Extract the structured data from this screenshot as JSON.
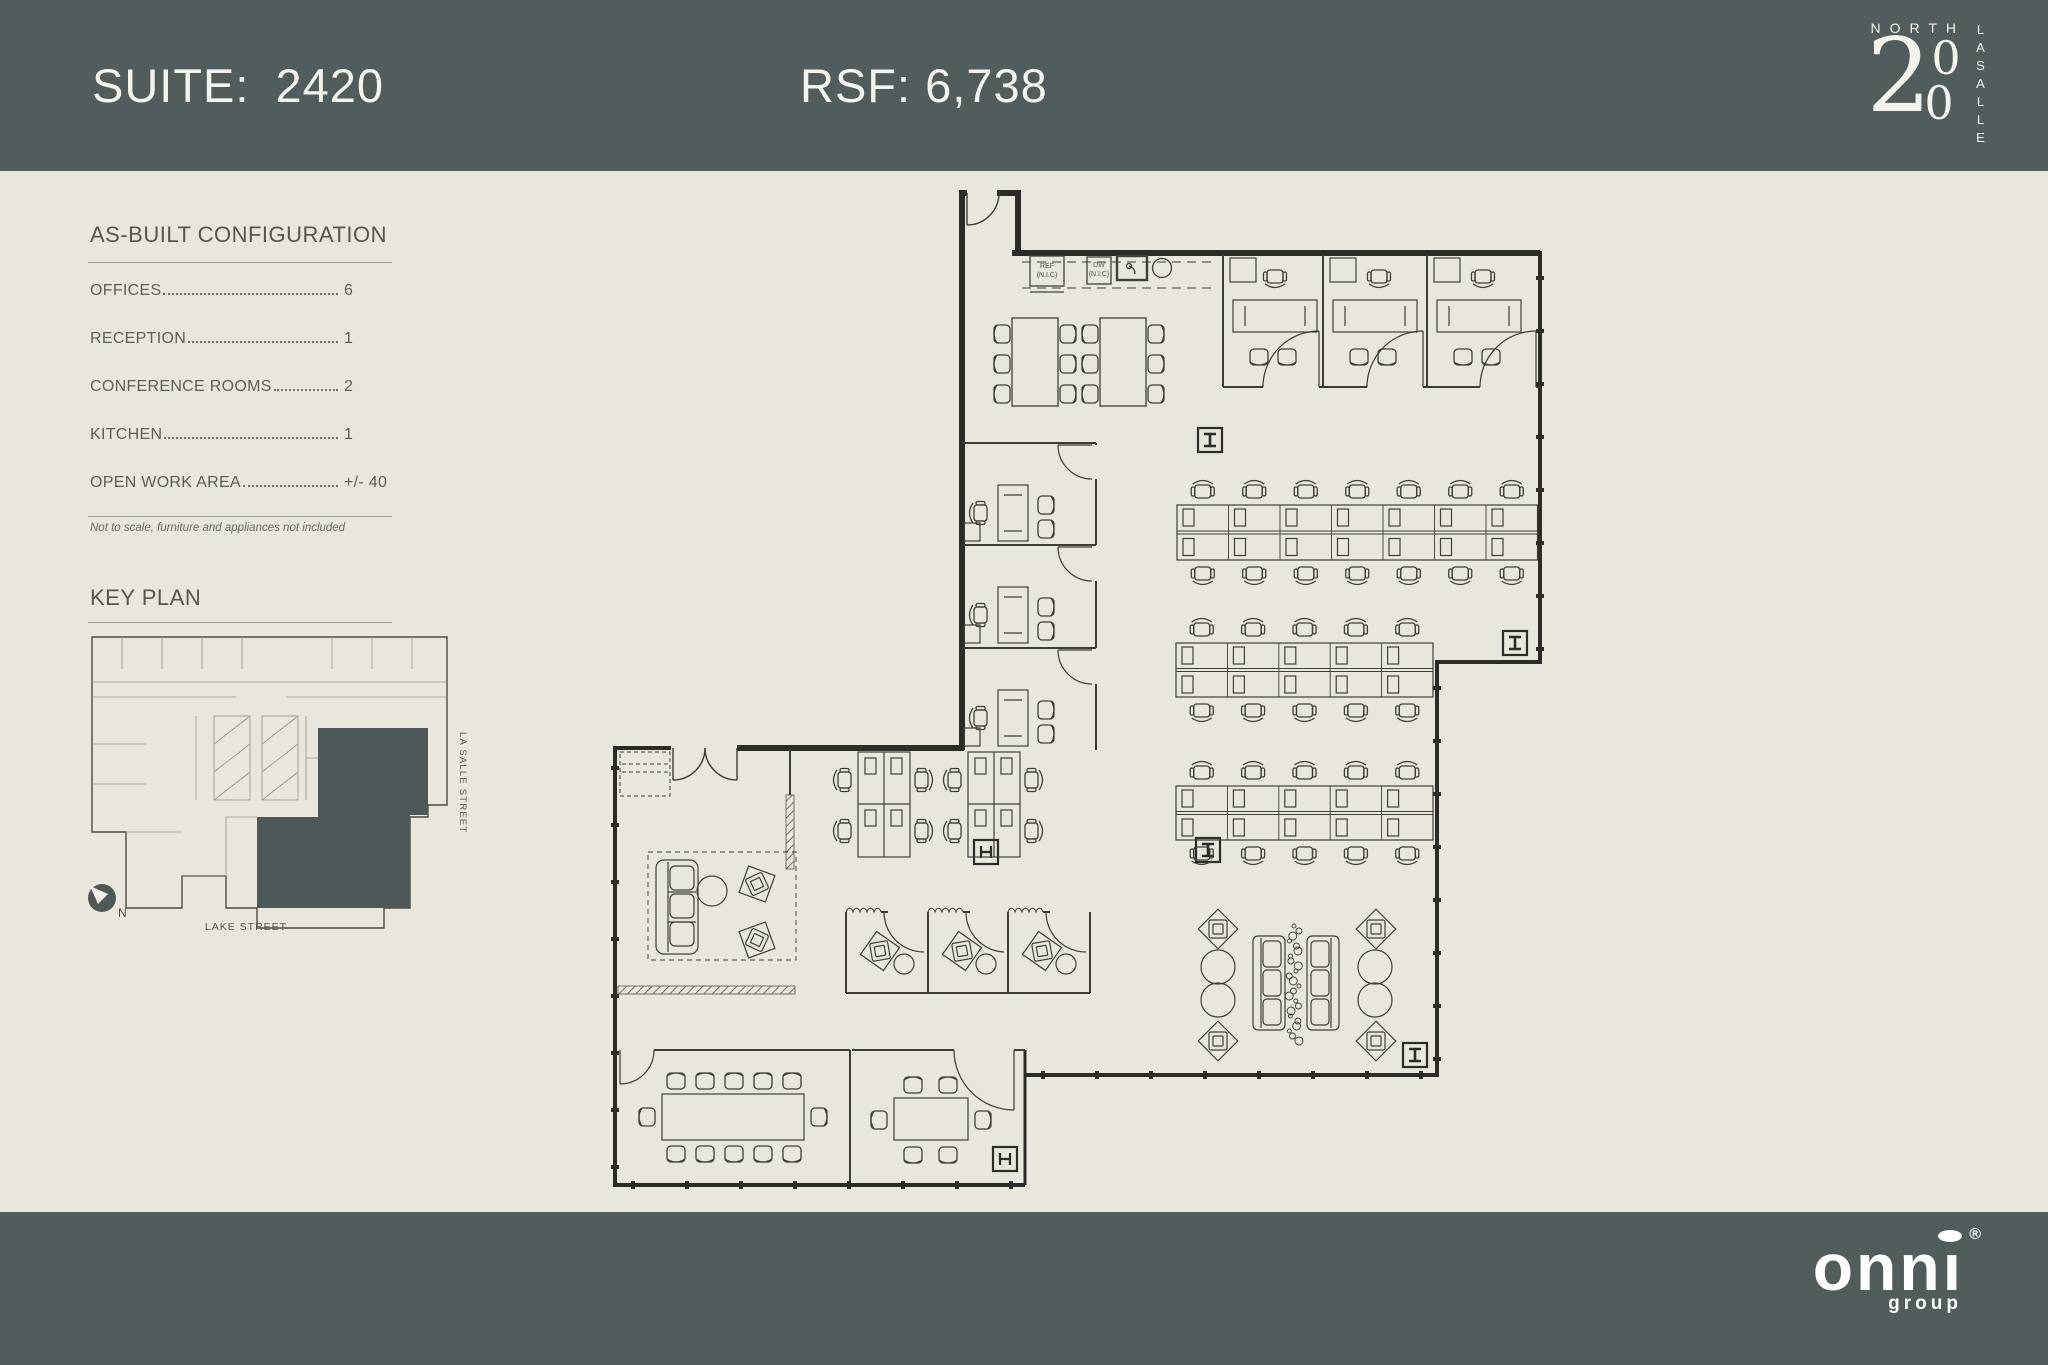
{
  "header": {
    "suite_label": "SUITE:",
    "suite_number": "2420",
    "rsf": "RSF: 6,738",
    "logo": {
      "north": "NORTH",
      "big_two": "2",
      "zero_top": "0",
      "zero_bottom": "0",
      "lasalle": "LASALLE"
    }
  },
  "sidebar": {
    "config_title": "AS-BUILT CONFIGURATION",
    "items": [
      {
        "label": "OFFICES",
        "value": "6"
      },
      {
        "label": "RECEPTION",
        "value": "1"
      },
      {
        "label": "CONFERENCE ROOMS",
        "value": "2"
      },
      {
        "label": "KITCHEN",
        "value": "1"
      },
      {
        "label": "OPEN WORK AREA",
        "value": "+/- 40"
      }
    ],
    "note": "Not to scale, furniture and appliances not included",
    "key_plan_title": "KEY PLAN",
    "key_plan": {
      "street_right": "LA SALLE STREET",
      "street_bottom": "LAKE STREET",
      "north_letter": "N"
    }
  },
  "plan": {
    "labels": {
      "ref_line1": "REF",
      "ref_line2": "(N.I.C)",
      "dw_line1": "DW",
      "dw_line2": "(N.I.C)"
    }
  },
  "footer": {
    "logo": {
      "word": "onnı",
      "reg": "®",
      "sub": "group"
    }
  }
}
